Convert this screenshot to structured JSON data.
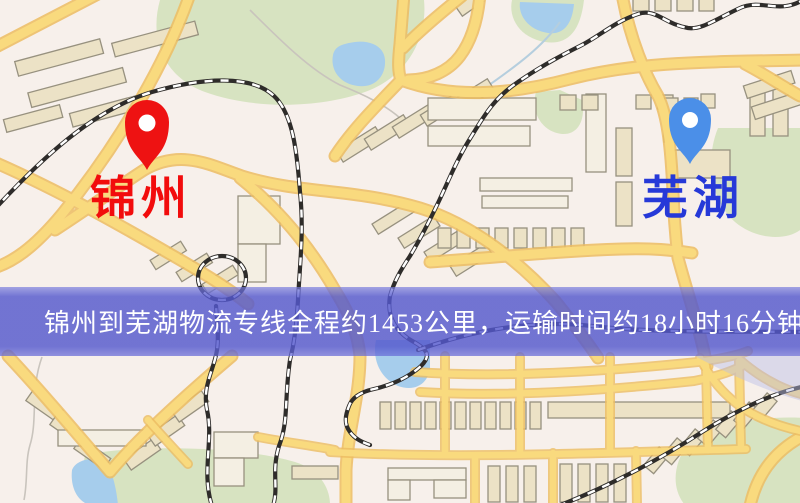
{
  "map": {
    "type": "street-map",
    "colors": {
      "background": "#f7f0eb",
      "road": "#f9da7e",
      "road_casing": "#edbd62",
      "building": "#ece2c6",
      "park": "#d7e3c1",
      "water": "#a6cdec",
      "railway": "#2e2c2a",
      "banner_overlay": "#5458cd"
    }
  },
  "markers": {
    "origin": {
      "label": "锦州",
      "pin_color": "#ee1212",
      "label_color": "#f20c0c",
      "pin_icon": "map-pin"
    },
    "destination": {
      "label": "芜湖",
      "pin_color": "#4b8fe8",
      "label_color": "#2639d8",
      "pin_icon": "map-pin"
    }
  },
  "banner": {
    "text": "锦州到芜湖物流专线全程约1453公里，运输时间约18小时16分钟.",
    "text_color": "#ffffff"
  },
  "route": {
    "origin": "锦州",
    "destination": "芜湖",
    "service": "物流专线",
    "distance_km": 1453,
    "duration_hours": 18,
    "duration_minutes": 16
  }
}
